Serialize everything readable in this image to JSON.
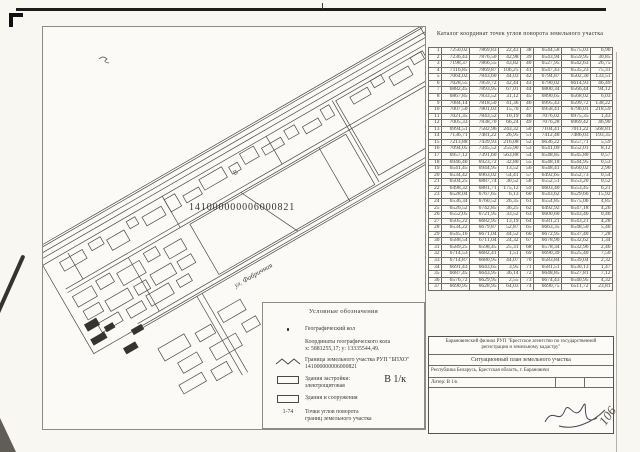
{
  "page": {
    "corner_page_number": "106"
  },
  "map": {
    "cadastral_number": "141000000006000821",
    "street_label": "ул. Фабричная",
    "building_letter": "В",
    "shapes": {
      "lines": [
        [
          0,
          4,
          450,
          4
        ],
        [
          0,
          9,
          450,
          9
        ],
        [
          0,
          14,
          450,
          14
        ],
        [
          0,
          20,
          450,
          20
        ],
        [
          10,
          52,
          446,
          52
        ],
        [
          10,
          56,
          446,
          56
        ],
        [
          55,
          118,
          470,
          118
        ],
        [
          55,
          124,
          470,
          124
        ],
        [
          30,
          22,
          30,
          52
        ],
        [
          140,
          20,
          140,
          56
        ],
        [
          260,
          20,
          260,
          52
        ],
        [
          80,
          56,
          80,
          118
        ],
        [
          300,
          56,
          300,
          118
        ],
        [
          335,
          22,
          335,
          116
        ],
        [
          210,
          56,
          240,
          118
        ],
        [
          120,
          124,
          120,
          215
        ],
        [
          126,
          124,
          126,
          215
        ]
      ],
      "rects": [
        [
          2,
          2,
          446,
          120
        ],
        [
          150,
          58,
          180,
          58
        ],
        [
          338,
          24,
          100,
          86
        ],
        [
          18,
          26,
          26,
          10
        ],
        [
          52,
          24,
          14,
          8
        ],
        [
          70,
          30,
          20,
          12
        ],
        [
          96,
          24,
          10,
          8
        ],
        [
          112,
          28,
          22,
          10
        ],
        [
          140,
          24,
          12,
          14
        ],
        [
          158,
          30,
          18,
          8
        ],
        [
          180,
          24,
          26,
          12
        ],
        [
          212,
          28,
          10,
          8
        ],
        [
          228,
          22,
          16,
          12
        ],
        [
          250,
          28,
          22,
          8
        ],
        [
          278,
          24,
          12,
          10
        ],
        [
          296,
          30,
          18,
          8
        ],
        [
          320,
          24,
          10,
          12
        ],
        [
          352,
          28,
          20,
          8
        ],
        [
          378,
          24,
          12,
          8
        ],
        [
          396,
          30,
          22,
          10
        ],
        [
          424,
          24,
          12,
          8
        ],
        [
          12,
          62,
          22,
          12
        ],
        [
          40,
          60,
          16,
          10
        ],
        [
          62,
          64,
          26,
          14
        ],
        [
          95,
          60,
          14,
          10
        ],
        [
          115,
          66,
          20,
          12
        ],
        [
          14,
          80,
          18,
          10
        ],
        [
          38,
          82,
          26,
          12
        ],
        [
          70,
          84,
          14,
          10
        ],
        [
          90,
          82,
          24,
          12
        ],
        [
          120,
          84,
          16,
          10
        ],
        [
          20,
          98,
          24,
          10
        ],
        [
          52,
          100,
          18,
          10
        ],
        [
          76,
          98,
          26,
          12
        ],
        [
          110,
          100,
          14,
          8
        ],
        [
          60,
          150,
          30,
          14
        ],
        [
          100,
          155,
          18,
          10
        ],
        [
          130,
          148,
          26,
          12
        ],
        [
          70,
          172,
          22,
          12
        ],
        [
          105,
          175,
          30,
          14
        ],
        [
          145,
          170,
          16,
          10
        ],
        [
          60,
          192,
          26,
          10
        ],
        [
          95,
          195,
          18,
          12
        ]
      ],
      "dark_rects": [
        [
          8,
          92,
          14,
          8
        ],
        [
          24,
          104,
          10,
          6
        ],
        [
          6,
          108,
          16,
          7
        ],
        [
          46,
          120,
          12,
          6
        ],
        [
          30,
          132,
          14,
          7
        ]
      ]
    }
  },
  "table": {
    "title": "Каталог координат точек углов поворота земельного участка",
    "rows_left": [
      [
        "1",
        "7250,02",
        "7869,83",
        "22,43"
      ],
      [
        "2",
        "7236,43",
        "7876,50",
        "42,98"
      ],
      [
        "3",
        "7198,37",
        "7866,55",
        "43,82"
      ],
      [
        "4",
        "7116,85",
        "7869,87",
        "106,25"
      ],
      [
        "5",
        "7064,02",
        "7843,60",
        "44,03"
      ],
      [
        "6",
        "7028,55",
        "7859,72",
        "42,44"
      ],
      [
        "7",
        "6882,45",
        "7893,95",
        "67,01"
      ],
      [
        "8",
        "6867,85",
        "7833,52",
        "31,12"
      ],
      [
        "9",
        "7084,14",
        "7818,50",
        "41,36"
      ],
      [
        "10",
        "7007,50",
        "7801,03",
        "15,70"
      ],
      [
        "11",
        "7021,35",
        "7843,52",
        "10,19"
      ],
      [
        "12",
        "7005,33",
        "7838,70",
        "66,24"
      ],
      [
        "13",
        "6994,51",
        "7582,96",
        "243,32"
      ],
      [
        "14",
        "7136,71",
        "7481,22",
        "26,95"
      ],
      [
        "15",
        "7213,88",
        "7439,93",
        "216,08"
      ],
      [
        "16",
        "7094,05",
        "7345,52",
        "255,90"
      ],
      [
        "17",
        "6957,12",
        "7391,60",
        "563,88"
      ],
      [
        "18",
        "6946,40",
        "6923,72",
        "32,80"
      ],
      [
        "19",
        "6541,45",
        "6944,95",
        "13,52"
      ],
      [
        "20",
        "6534,42",
        "6963,02",
        "54,41"
      ],
      [
        "21",
        "6504,25",
        "6887,74",
        "30,52"
      ],
      [
        "22",
        "6498,32",
        "6881,71",
        "175,12"
      ],
      [
        "23",
        "6528,04",
        "6767,65",
        "6,13"
      ],
      [
        "24",
        "6536,34",
        "6760,52",
        "26,35"
      ],
      [
        "25",
        "6526,52",
        "6742,85",
        "36,25"
      ],
      [
        "26",
        "6552,05",
        "6721,95",
        "33,52"
      ],
      [
        "27",
        "6505,22",
        "6682,95",
        "13,19"
      ],
      [
        "28",
        "6534,22",
        "6679,87",
        "52,87"
      ],
      [
        "29",
        "6545,16",
        "6671,04",
        "44,52"
      ],
      [
        "30",
        "6588,54",
        "6711,04",
        "24,32"
      ],
      [
        "31",
        "6589,25",
        "6598,45",
        "25,31"
      ],
      [
        "32",
        "6714,53",
        "6682,41",
        "1,51"
      ],
      [
        "33",
        "6714,87",
        "6680,95",
        "44,07"
      ],
      [
        "34",
        "6691,43",
        "6643,65",
        "3,95"
      ],
      [
        "35",
        "6687,45",
        "6643,95",
        "36,14"
      ],
      [
        "36",
        "6576,72",
        "6629,95",
        "2,55"
      ],
      [
        "37",
        "6690,95",
        "6628,95",
        "64,03"
      ]
    ],
    "rows_right": [
      [
        "38",
        "6544,58",
        "6575,03",
        "6,90"
      ],
      [
        "39",
        "6543,94",
        "6559,95",
        "30,85"
      ],
      [
        "40",
        "6527,95",
        "6542,63",
        "26,75"
      ],
      [
        "41",
        "6547,43",
        "6535,23",
        "75,31"
      ],
      [
        "42",
        "6794,87",
        "6502,30",
        "133,51"
      ],
      [
        "43",
        "6790,02",
        "6614,93",
        "46,49"
      ],
      [
        "44",
        "6800,34",
        "6566,44",
        "94,12"
      ],
      [
        "45",
        "6890,65",
        "6568,02",
        "6,03"
      ],
      [
        "46",
        "6995,43",
        "6599,72",
        "138,22"
      ],
      [
        "47",
        "6958,41",
        "6796,01",
        "218,59"
      ],
      [
        "48",
        "7076,02",
        "6975,35",
        "1,43"
      ],
      [
        "49",
        "7076,28",
        "6969,42",
        "46,90"
      ],
      [
        "50",
        "7104,41",
        "7011,22",
        "568,81"
      ],
      [
        "51",
        "7412,48",
        "7486,03",
        "193,35"
      ],
      [
        "52",
        "6636,22",
        "6557,71",
        "5,59"
      ],
      [
        "53",
        "6541,09",
        "6552,01",
        "8,12"
      ],
      [
        "54",
        "6548,85",
        "6545,80",
        "0,57"
      ],
      [
        "55",
        "6548,18",
        "6544,95",
        "0,53"
      ],
      [
        "56",
        "6548,41",
        "6560,02",
        "2,96"
      ],
      [
        "57",
        "6492,65",
        "6552,73",
        "0,54"
      ],
      [
        "58",
        "6552,51",
        "6553,20",
        "0,52"
      ],
      [
        "59",
        "6603,40",
        "6553,45",
        "6,21"
      ],
      [
        "60",
        "6543,62",
        "6529,66",
        "15,92"
      ],
      [
        "61",
        "6554,85",
        "6575,06",
        "4,85"
      ],
      [
        "62",
        "6492,92",
        "6547,18",
        "4,26"
      ],
      [
        "63",
        "6600,60",
        "6543,46",
        "0,46"
      ],
      [
        "64",
        "6581,21",
        "6543,21",
        "4,28"
      ],
      [
        "65",
        "6663,35",
        "6548,50",
        "5,46"
      ],
      [
        "66",
        "6672,95",
        "6537,40",
        "7,28"
      ],
      [
        "67",
        "6678,90",
        "6532,62",
        "1,34"
      ],
      [
        "68",
        "6578,34",
        "6532,96",
        "2,46"
      ],
      [
        "69",
        "6690,39",
        "6525,40",
        "7,50"
      ],
      [
        "70",
        "6583,84",
        "6539,04",
        "2,32"
      ],
      [
        "71",
        "6581,51",
        "6530,13",
        "1,47"
      ],
      [
        "72",
        "6648,85",
        "6527,81",
        "7,12"
      ],
      [
        "73",
        "6674,43",
        "6540,95",
        "4,32"
      ],
      [
        "74",
        "6690,75",
        "6511,72",
        "23,81"
      ]
    ]
  },
  "legend": {
    "title": "Условные обозначения",
    "items": [
      {
        "symbol": "dot-icon",
        "label": "Географический кол"
      },
      {
        "symbol": "none",
        "label": "Координаты географического кола",
        "label2": "х: 5881255,17;  у: 13335544,49."
      },
      {
        "symbol": "zigzag-line-icon",
        "label": "Граница земельного участка РУП \"БПХО\"",
        "label2": "141000000006000821"
      },
      {
        "symbol": "building-rect-icon",
        "label": "Здания застройки:",
        "label2": "электрощитовая",
        "extra": "В 1/к"
      },
      {
        "symbol": "building-rect-icon",
        "label": "Здания и сооружения"
      },
      {
        "symbol": "range-text",
        "symbol_text": "1-74",
        "label": "Точки углов поворота",
        "label2": "границ земельного участка"
      }
    ]
  },
  "titleblock": {
    "org_line": "Барановичский филиал РУП \"Брестское агентство по государственной регистрации и земельному кадастру\"",
    "doc_title": "Ситуационный план земельного участка",
    "location": "Республика Беларусь, Брестская область, г. Барановичи",
    "liter": "Литер: В 1/к",
    "col1": [
      "Картограмма",
      "Масштаб",
      "1 : 5000",
      "Составил",
      "Проверил"
    ],
    "col2": [
      "Фамилия",
      "Лист 1",
      "Фандеев Н.Г.",
      "Крамнев Е.Б.",
      "Щербакевич А.Н."
    ],
    "col3": [
      "Подпись",
      "Листов 1",
      "",
      "",
      ""
    ],
    "col4": [
      "Стр. 1",
      "Дата",
      "20.10.2011 г.",
      "20.10.2011 г.",
      ""
    ]
  }
}
